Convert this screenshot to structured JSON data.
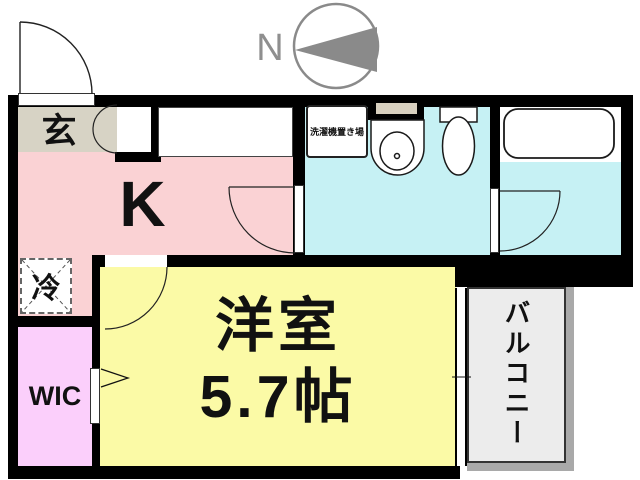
{
  "plan": {
    "type": "apartment-floor-plan",
    "compass": {
      "north_label": "N"
    },
    "rooms": {
      "entrance": {
        "label": "玄"
      },
      "kitchen": {
        "label": "K"
      },
      "washroom": {
        "washer_area_label": "洗濯機置き場"
      },
      "western_room": {
        "label": "洋室",
        "size": "5.7帖"
      },
      "refrigerator_space": {
        "label": "冷"
      },
      "walk_in_closet": {
        "label": "WIC"
      },
      "balcony": {
        "label": "バルコニー"
      }
    },
    "fixtures": [
      "stove-icon",
      "sink-icon",
      "toilet-icon",
      "bathtub-icon",
      "entrance-door-swing",
      "kitchen-door-swing",
      "bathroom-door-swing",
      "western-room-door-swing",
      "entrance-double-door-swing",
      "sliding-window",
      "refrigerator-dashed-box",
      "wic-door-arrow",
      "north-compass-icon"
    ],
    "colors": {
      "kitchen": "#fad2d4",
      "entrance": "#d7d3c5",
      "washroom": "#c6f1f4",
      "western_room": "#fbfaa6",
      "walk_in_closet": "#fbcffb",
      "balcony_floor": "#ececec",
      "balcony_shadow": "#a9a9a9",
      "wall": "#000000",
      "compass_gray": "#8a8a8a"
    }
  }
}
